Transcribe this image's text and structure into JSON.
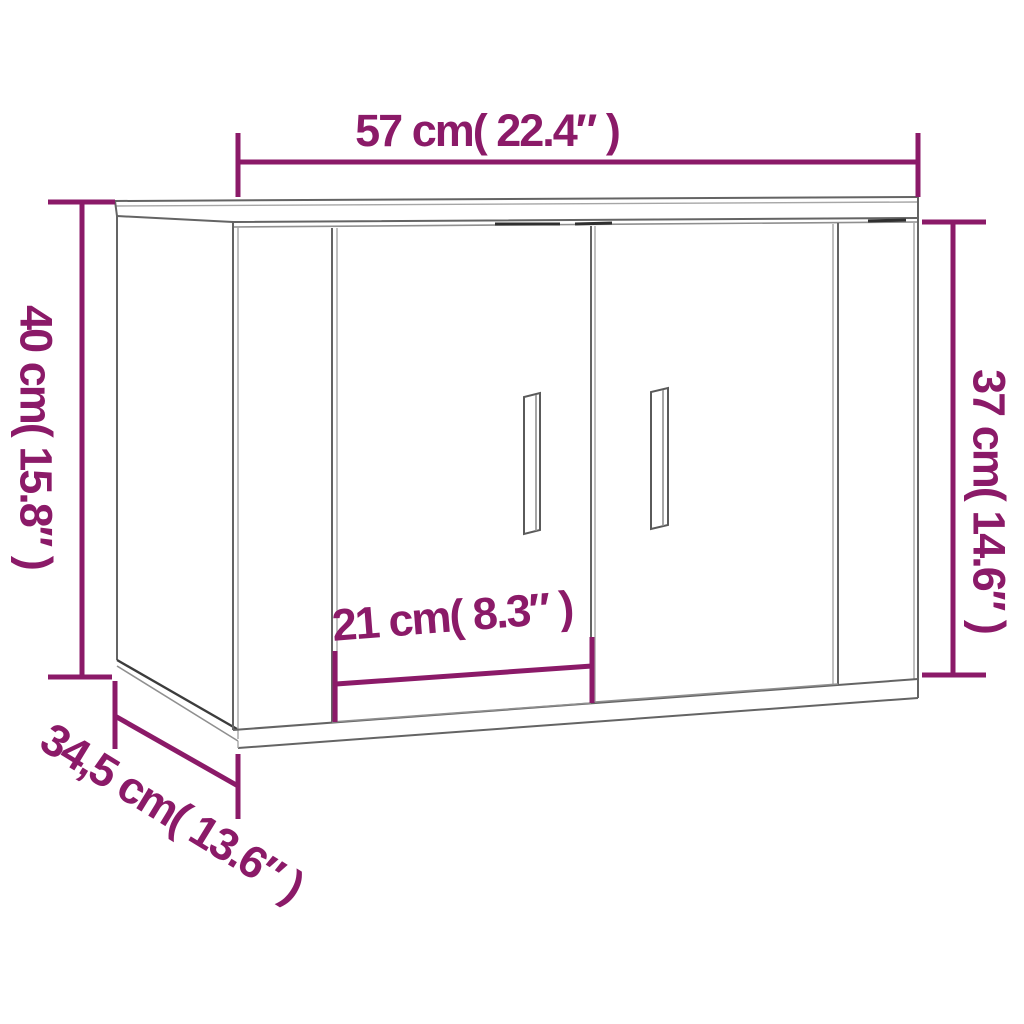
{
  "diagram": {
    "labels": {
      "width_top": "57 cm( 22.4″ )",
      "height_left": "40 cm( 15.8″ )",
      "height_right": "37 cm( 14.6″ )",
      "door_width": "21 cm( 8.3″ )",
      "depth_bottom": "34,5 cm( 13.6″ )"
    },
    "colors": {
      "dimension": "#8b1a68",
      "line_art": "#646464",
      "background": "#ffffff"
    }
  }
}
